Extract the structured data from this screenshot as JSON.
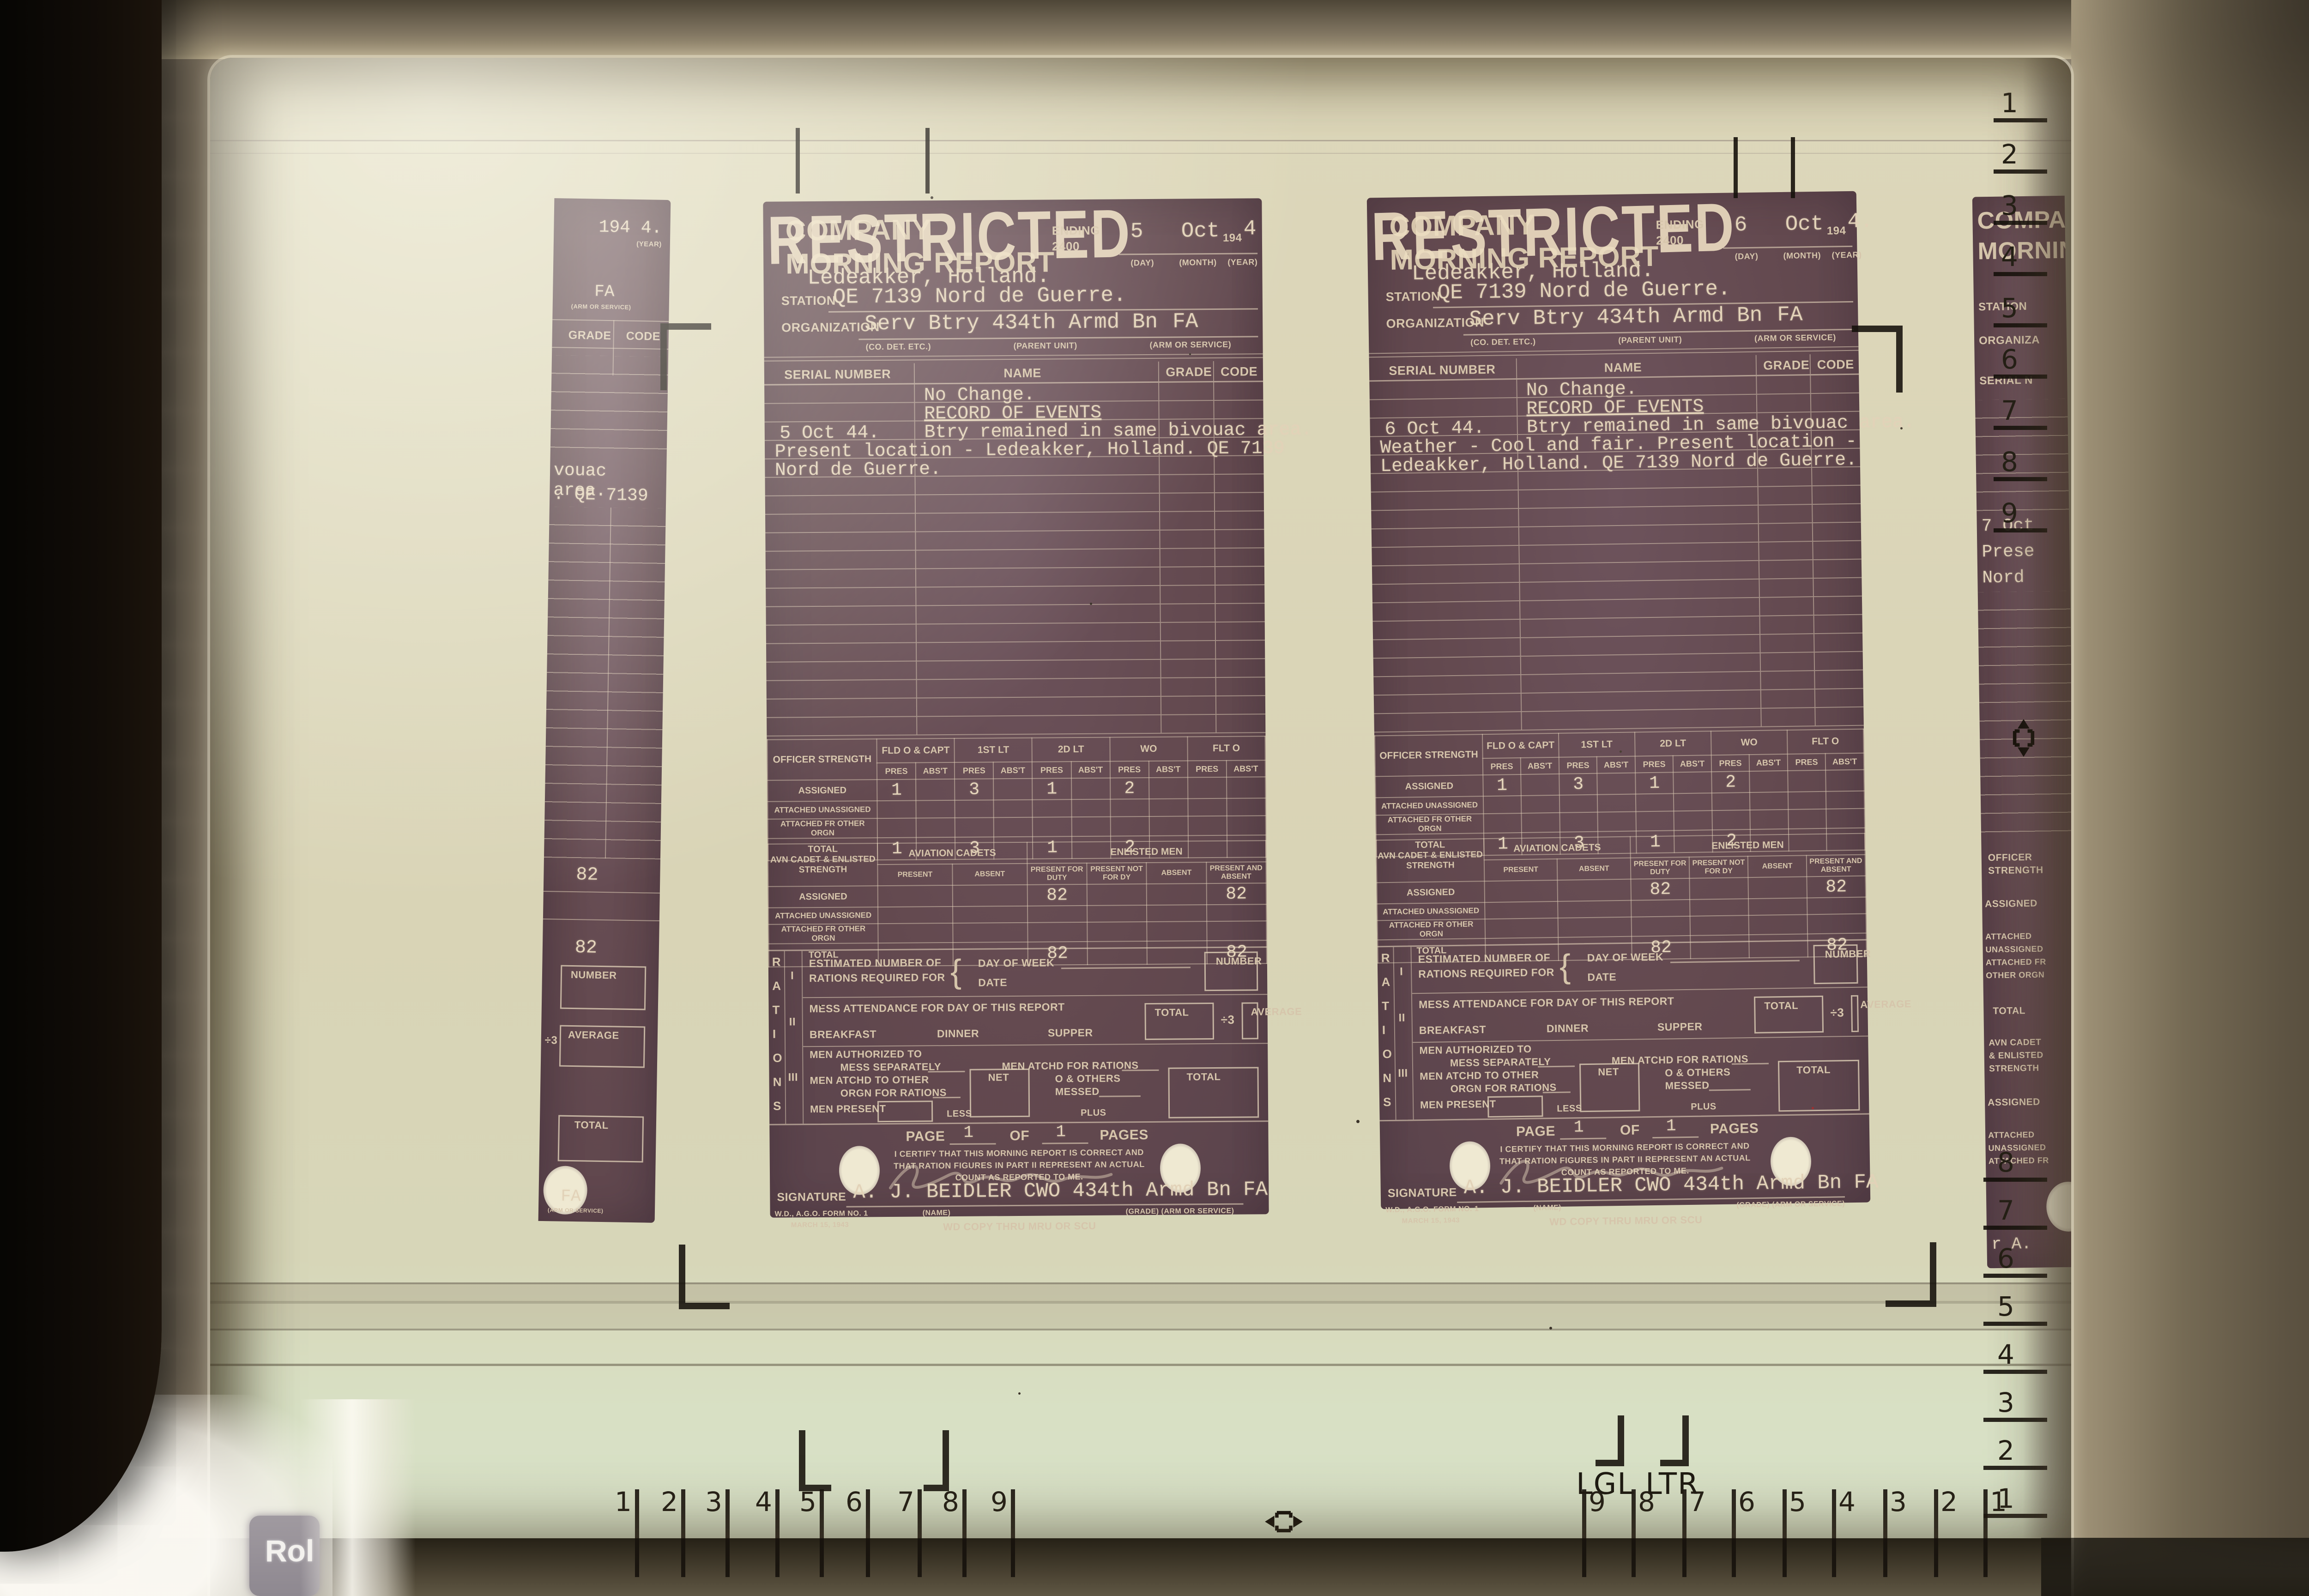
{
  "device": {
    "roll_key_label": "Rol"
  },
  "screen": {
    "size_marks": {
      "legal": "LGL",
      "letter": "LTR"
    },
    "rulers": {
      "bottom_left": [
        "1",
        "2",
        "3",
        "4",
        "5",
        "6",
        "7",
        "8",
        "9"
      ],
      "bottom_right": [
        "9",
        "8",
        "7",
        "6",
        "5",
        "4",
        "3",
        "2",
        "1"
      ],
      "right_top": [
        "1",
        "2",
        "3",
        "4",
        "5",
        "6",
        "7",
        "8",
        "9"
      ],
      "right_bottom": [
        "8",
        "7",
        "6",
        "5",
        "4",
        "3",
        "2",
        "1"
      ]
    }
  },
  "form": {
    "classification": "RESTRICTED",
    "title_line1": "COMPANY",
    "title_line2": "MORNING REPORT",
    "ending_label": "ENDING",
    "ending_time": "2400",
    "year_prefix": "194",
    "date_sublabels": [
      "(DAY)",
      "(MONTH)",
      "(YEAR)"
    ],
    "station_label": "STATION",
    "organization_label": "ORGANIZATION",
    "org_sublabels": [
      "(CO. DET. ETC.)",
      "(PARENT UNIT)",
      "(ARM OR SERVICE)"
    ],
    "columns": [
      "SERIAL NUMBER",
      "NAME",
      "GRADE",
      "CODE"
    ],
    "record_of_events": "RECORD OF EVENTS",
    "officer": {
      "label": "OFFICER STRENGTH",
      "groups": [
        "FLD O & CAPT",
        "1ST LT",
        "2D LT",
        "WO",
        "FLT O"
      ],
      "sub": [
        "PRES",
        "ABS'T"
      ],
      "rows": [
        "ASSIGNED",
        "ATTACHED UNASSIGNED",
        "ATTACHED FR OTHER ORGN",
        "TOTAL"
      ]
    },
    "enlisted": {
      "label": "AVN CADET & ENLISTED STRENGTH",
      "group1": "AVIATION CADETS",
      "group2": "ENLISTED MEN",
      "sub": [
        "PRESENT",
        "ABSENT",
        "PRESENT FOR DUTY",
        "PRESENT NOT FOR DY",
        "ABSENT",
        "PRESENT AND ABSENT"
      ],
      "rows": [
        "ASSIGNED",
        "ATTACHED UNASSIGNED",
        "ATTACHED FR OTHER ORGN",
        "TOTAL"
      ]
    },
    "rations": {
      "rail": "RATIONS",
      "parts": [
        "I",
        "II",
        "III"
      ],
      "p1_label1": "ESTIMATED NUMBER OF",
      "p1_label2": "RATIONS REQUIRED FOR",
      "day_of_week": "DAY OF WEEK",
      "date_label": "DATE",
      "number_label": "NUMBER",
      "p2_label": "MESS ATTENDANCE FOR DAY OF THIS REPORT",
      "meals": [
        "BREAKFAST",
        "DINNER",
        "SUPPER"
      ],
      "total_label": "TOTAL",
      "divide_label": "÷3",
      "average_label": "AVERAGE",
      "p3_line1": "MEN AUTHORIZED TO",
      "p3_line2": "MESS SEPARATELY",
      "p3_line3": "MEN ATCHD FOR RATIONS",
      "p3_line4": "MEN ATCHD TO OTHER",
      "p3_line5": "ORGN FOR RATIONS",
      "net_label": "NET",
      "p3_line6": "O & OTHERS",
      "p3_line7": "MESSED",
      "men_present": "MEN PRESENT",
      "less_label": "LESS",
      "plus_label": "PLUS"
    },
    "page_label": "PAGE",
    "of_label": "OF",
    "pages_label": "PAGES",
    "certify": [
      "I CERTIFY THAT THIS MORNING REPORT IS CORRECT AND",
      "THAT RATION FIGURES IN PART II REPRESENT AN ACTUAL",
      "COUNT AS REPORTED TO ME."
    ],
    "signature_label": "SIGNATURE",
    "name_sublabel": "(NAME)",
    "grade_sublabel": "(GRADE)  (ARM OR SERVICE)",
    "form_number": "W.D., A.G.O. FORM NO. 1",
    "form_date": "MARCH 15, 1943",
    "copy_note": "WD COPY THRU MRU OR SCU"
  },
  "documents": [
    {
      "id": "left-report",
      "day": "5",
      "month": "Oct",
      "year_digit": "4",
      "location": "Ledeakker, Holland.",
      "station": "QE 7139 Nord de Guerre.",
      "organization": "Serv Btry 434th Armd Bn",
      "arm": "FA",
      "no_change": "No Change.",
      "events": [
        {
          "date": "5 Oct 44.",
          "text": "Btry remained in same bivouac area."
        },
        {
          "date": "",
          "text": "Present location - Ledeakker, Holland. QE 7139"
        },
        {
          "date": "",
          "text": "Nord de Guerre."
        }
      ],
      "officer_assigned": [
        "1",
        "",
        "3",
        "",
        "1",
        "",
        "2",
        "",
        "",
        ""
      ],
      "officer_total": [
        "1",
        "",
        "3",
        "",
        "1",
        "",
        "2",
        "",
        "",
        ""
      ],
      "enlisted_assigned": [
        "",
        "",
        "82",
        "",
        "",
        "82"
      ],
      "enlisted_total": [
        "",
        "",
        "82",
        "",
        "",
        "82"
      ],
      "page": "1",
      "pages": "1",
      "signature": "A. J. BEIDLER CWO 434th Armd Bn  FA"
    },
    {
      "id": "right-report",
      "day": "6",
      "month": "Oct",
      "year_digit": "4.",
      "location": "Ledeakker, Holland.",
      "station": "QE 7139 Nord de Guerre.",
      "organization": "Serv Btry 434th Armd Bn",
      "arm": "FA",
      "no_change": "No Change.",
      "events": [
        {
          "date": "6 Oct 44.",
          "text": "Btry remained in same bivouac area."
        },
        {
          "date": "",
          "text": "Weather - Cool and fair. Present location -"
        },
        {
          "date": "",
          "text": "Ledeakker, Holland. QE 7139 Nord de Guerre."
        }
      ],
      "officer_assigned": [
        "1",
        "",
        "3",
        "",
        "1",
        "",
        "2",
        "",
        "",
        ""
      ],
      "officer_total": [
        "1",
        "",
        "3",
        "",
        "1",
        "",
        "2",
        "",
        "",
        ""
      ],
      "enlisted_assigned": [
        "",
        "",
        "82",
        "",
        "",
        "82"
      ],
      "enlisted_total": [
        "",
        "",
        "82",
        "",
        "",
        "82"
      ],
      "page": "1",
      "pages": "1",
      "signature": "A. J. BEIDLER CWO 434th Armd Bn  FA"
    }
  ],
  "left_fragment": {
    "year": "194 4.",
    "year_sub": "(YEAR)",
    "arm": "FA",
    "arm_sub": "(ARM OR SERVICE)",
    "grade": "GRADE",
    "code": "CODE",
    "line1": "vouac area.",
    "line2": ". QE 7139",
    "value1": "82",
    "value2": "82",
    "number_label": "NUMBER",
    "divide_label": "÷3",
    "average_label": "AVERAGE",
    "total_label": "TOTAL",
    "arm_bottom": "FA",
    "arm_bottom_sub": "(ARM OR SERVICE)"
  },
  "right_fragment": {
    "stamp1": "COMPAN",
    "stamp2": "MORNIN",
    "station_label": "STATION",
    "organization_label": "ORGANIZA",
    "serial_label": "SERIAL N",
    "typed1": "7 Oct",
    "typed2": "Prese",
    "typed3": "Nord",
    "officer1": "OFFICER",
    "officer2": "STRENGTH",
    "assigned": "ASSIGNED",
    "attached1": "ATTACHED",
    "attached2": "UNASSIGNED",
    "attached3": "ATTACHED FR",
    "attached4": "OTHER ORGN",
    "total": "TOTAL",
    "avn1": "AVN CADET",
    "avn2": "& ENLISTED",
    "avn3": "STRENGTH",
    "sig_fragment": "r A."
  }
}
